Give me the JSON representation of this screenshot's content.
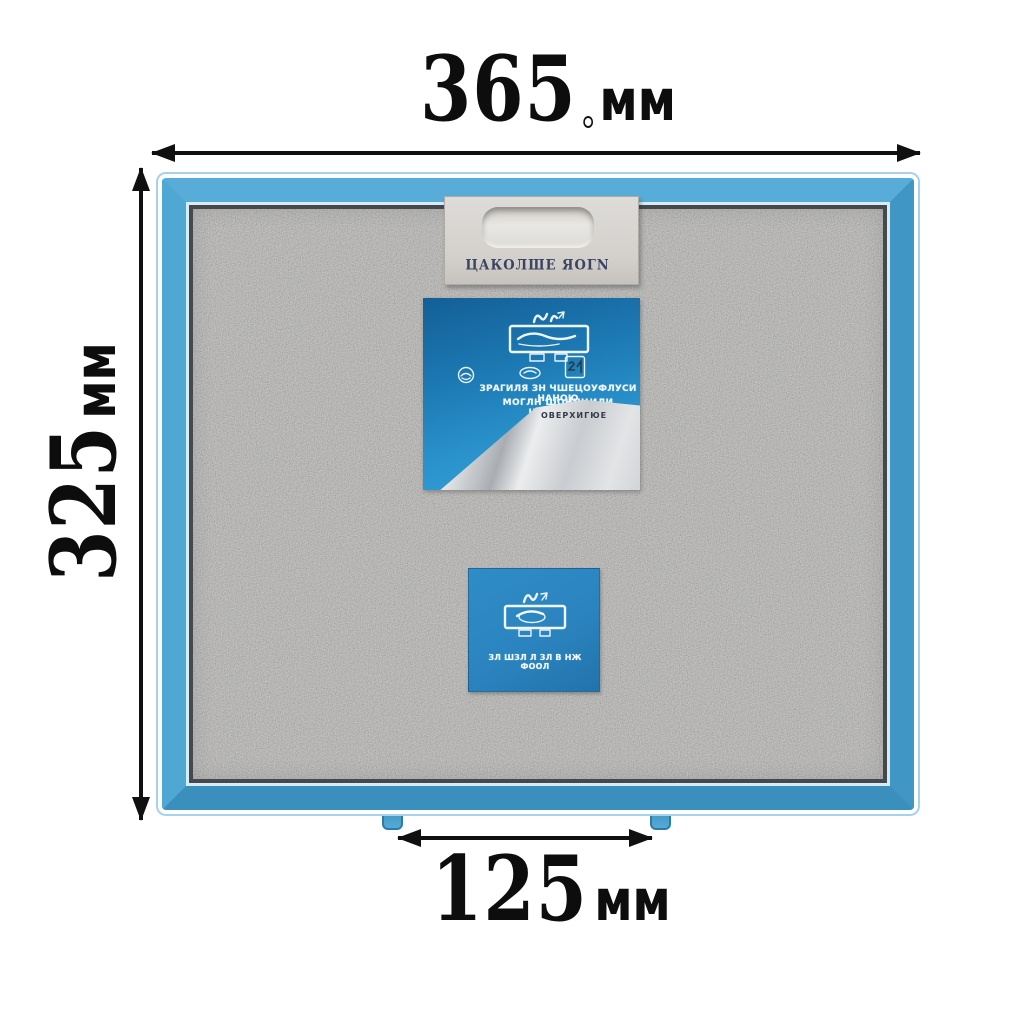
{
  "product": {
    "type_note": "metal grease filter with blue aluminium frame",
    "colors": {
      "frame_blue": "#4ba4d2",
      "frame_outline_blue": "#a5d3ec",
      "mesh_gray": "#b1b0ad",
      "large_sticker_blue": "#1d7ab4",
      "small_sticker_blue": "#2b84bf",
      "dimension_text": "#0d0d0d"
    }
  },
  "dimension_labels": {
    "top": {
      "value": "365",
      "unit": "мм"
    },
    "left": {
      "value": "325",
      "unit": "мм"
    },
    "bottom": {
      "value": "125",
      "unit": "мм"
    }
  },
  "filter": {
    "handle": {
      "embossed_text": "ЦАКОЛШЕ ЯОГN"
    },
    "large_sticker": {
      "icons": [
        "hood-steam-icon",
        "round-stamp-icon",
        "oval-mark-icon",
        "square-badge-icon"
      ],
      "text_line1": "ЗРАГИЛЯ ЗН ЧШЕЦОУФЛУСИ НАНОЮ",
      "text_line2": "МОГЛН ШОННЦИЛИ ШИУЛЮГУ",
      "peel_text": "ОВЕРХИГЮЕ"
    },
    "small_sticker": {
      "icon": "hood-steam-icon",
      "text_line1": "ЗЛ ШЗЛ Л ЗЛ В НЖ ФООЛ"
    }
  }
}
